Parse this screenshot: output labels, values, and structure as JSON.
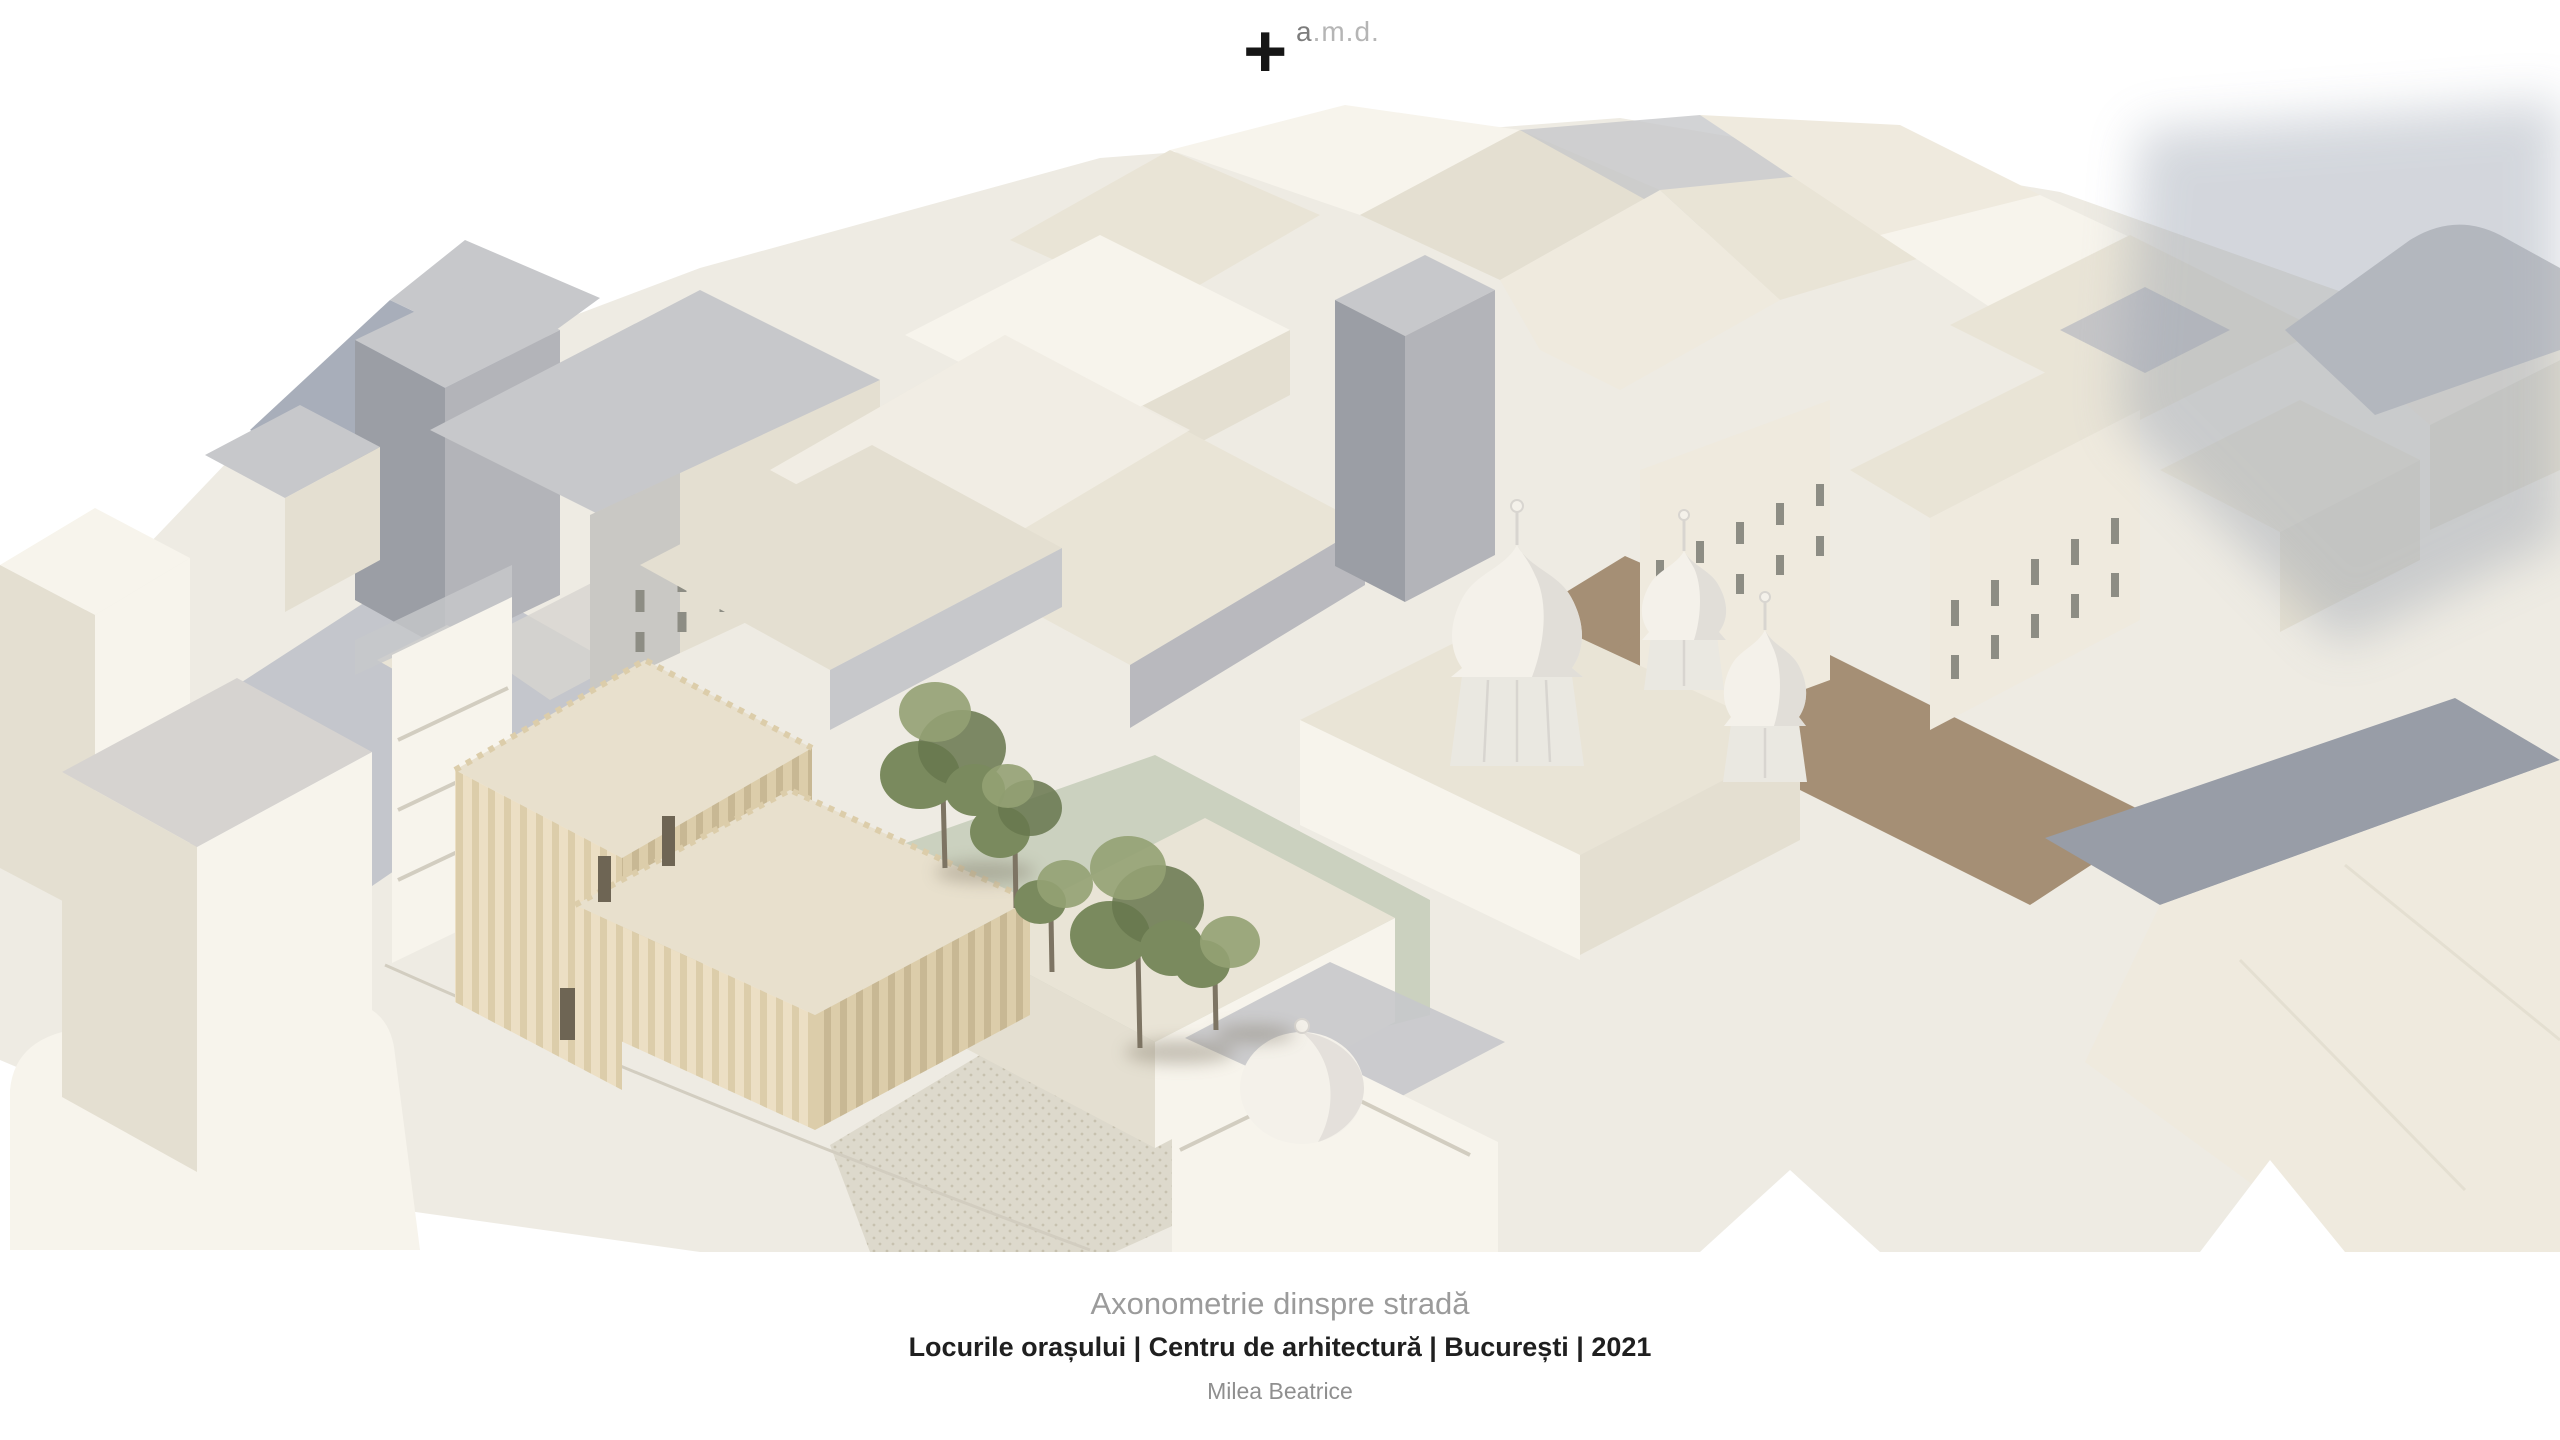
{
  "logo": {
    "symbol": "+",
    "prefix": "a",
    "rest": ".m.d."
  },
  "captions": {
    "title": "Axonometrie dinspre stradă",
    "subtitle": "Locurile orașului | Centru de arhitectură | București | 2021",
    "author": "Milea Beatrice"
  },
  "palette": {
    "bg": "#ffffff",
    "ground": "#eeebe3",
    "street": "#b9bdc6",
    "street_warm": "#d7d5d0",
    "pavement": "#ddd9cc",
    "pavement_dot": "#c7c1af",
    "lawn": "#cbd1bf",
    "dirt": "#a58f75",
    "cream_wall": "#efeade",
    "cream_wall2": "#e4dfd1",
    "cream_roof": "#e9e4d6",
    "white_wall": "#f7f4ec",
    "gray_roof": "#c7c8cb",
    "gray_wall": "#b3b4b9",
    "blue_gray": "#a8aeba",
    "slab_gray": "#9b9ea5",
    "shadow_soft": "#98a0ae",
    "band_gray": "#989da7",
    "courtyard_gray": "#b8bbc1",
    "beige_light": "#ecdfc4",
    "beige_mid": "#dccdaa",
    "beige_dark": "#c8b894",
    "beige_roof": "#e8e0cd",
    "roof_flat_gray": "#d6d3d0",
    "tree_green": "#7a8a5e",
    "tree_green_dark": "#67774d",
    "tree_green_light": "#93a173",
    "trunk": "#7d7463",
    "dome_white": "#f4f1ea",
    "dome_shade": "#d8d5d0",
    "drum": "#eae8e1",
    "window_slot": "#8d8d84",
    "window_dark": "#6e6554",
    "curb": "#d2cdc0",
    "logo_plus": "#161616",
    "logo_a": "#7c7c7c",
    "logo_rest": "#b5b5b5",
    "caption_title": "#9b9b9b",
    "caption_sub": "#1f1f1f",
    "caption_author": "#8f8f8f"
  }
}
